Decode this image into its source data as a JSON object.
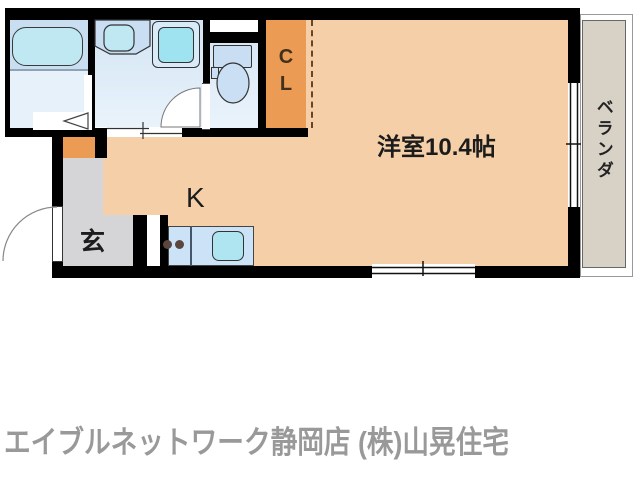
{
  "labels": {
    "main_room": "洋室10.4帖",
    "kitchen": "K",
    "entrance": "玄",
    "closet": "CL",
    "veranda": "ベランダ"
  },
  "caption": "エイブルネットワーク静岡店 (株)山晃住宅",
  "colors": {
    "wall": "#000000",
    "room-peach": "#F4CFA7",
    "closet-orange": "#EC9B55",
    "entrance-gray": "#D5D5D7",
    "veranda-beige": "#D8D1C6",
    "wet-top": "#C9DFF1",
    "wet-bottom": "#E6F1FA",
    "fixture-blue": "#C9DEF3",
    "fixture-cyan": "#AEE5F0",
    "counter-blue": "#CCE2F6",
    "burner-brown": "#5A463C",
    "caption-gray": "#999999",
    "label-dark": "#1C1C1C",
    "cl-text": "#42301E",
    "dash-brown": "#6B4423"
  }
}
